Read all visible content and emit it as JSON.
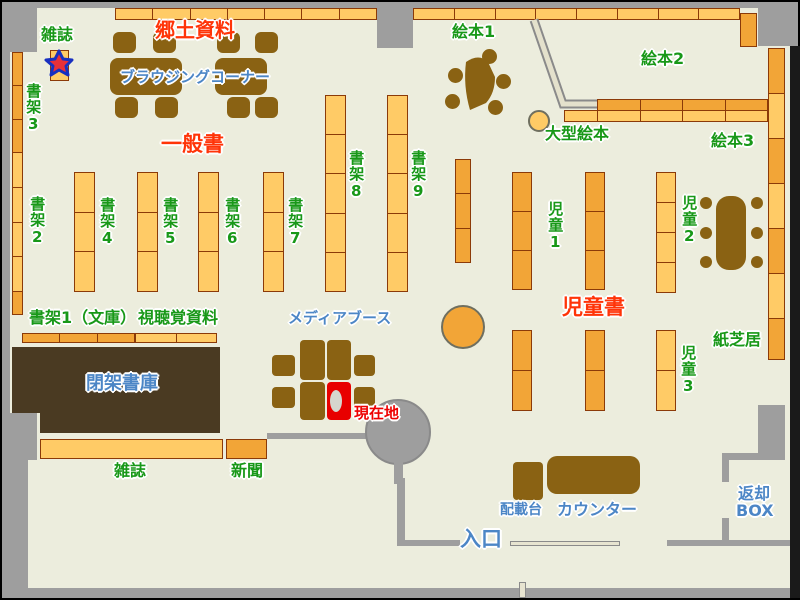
{
  "map_title": "library-floor-map",
  "palette": {
    "floor": "#ECEDDD",
    "wall_gray": "#9E9E9E",
    "shelf_light": "#FFCB66",
    "shelf_dark": "#F2A537",
    "shelf_border": "#8B3A08",
    "furniture_brown": "#8A6213",
    "closed_stacks_brown": "#4A3A22",
    "label_green": "#189818",
    "label_red": "#FF3408",
    "label_blue": "#4C86C6",
    "current_location_red": "#E80000"
  },
  "labels": [
    {
      "name": "label-zasshi-top",
      "text": "雑誌",
      "x": 41,
      "y": 26,
      "color": "green",
      "size": 16,
      "vertical": false
    },
    {
      "name": "label-shoka3",
      "text": "書架3",
      "x": 25,
      "y": 83,
      "color": "green",
      "size": 15,
      "vertical": true
    },
    {
      "name": "label-shoka2",
      "text": "書架2",
      "x": 29,
      "y": 196,
      "color": "green",
      "size": 15,
      "vertical": true
    },
    {
      "name": "label-kyodo-shiryo",
      "text": "郷土資料",
      "x": 155,
      "y": 20,
      "color": "red",
      "size": 20,
      "vertical": false
    },
    {
      "name": "label-browsing-corner",
      "text": "ブラウジングコーナー",
      "x": 120,
      "y": 69,
      "color": "blue",
      "size": 15,
      "vertical": false
    },
    {
      "name": "label-ippansho",
      "text": "一般書",
      "x": 161,
      "y": 133,
      "color": "red",
      "size": 21,
      "vertical": false
    },
    {
      "name": "label-shoka4",
      "text": "書架4",
      "x": 99,
      "y": 197,
      "color": "green",
      "size": 15,
      "vertical": true
    },
    {
      "name": "label-shoka5",
      "text": "書架5",
      "x": 162,
      "y": 197,
      "color": "green",
      "size": 15,
      "vertical": true
    },
    {
      "name": "label-shoka6",
      "text": "書架6",
      "x": 224,
      "y": 197,
      "color": "green",
      "size": 15,
      "vertical": true
    },
    {
      "name": "label-shoka7",
      "text": "書架7",
      "x": 287,
      "y": 197,
      "color": "green",
      "size": 15,
      "vertical": true
    },
    {
      "name": "label-shoka8",
      "text": "書架8",
      "x": 348,
      "y": 150,
      "color": "green",
      "size": 15,
      "vertical": true
    },
    {
      "name": "label-shoka9",
      "text": "書架9",
      "x": 410,
      "y": 150,
      "color": "green",
      "size": 15,
      "vertical": true
    },
    {
      "name": "label-shoka1-bunko",
      "text": "書架1（文庫）",
      "x": 29,
      "y": 309,
      "color": "green",
      "size": 16,
      "vertical": false
    },
    {
      "name": "label-shichokaku-shiryo",
      "text": "視聴覚資料",
      "x": 138,
      "y": 309,
      "color": "green",
      "size": 16,
      "vertical": false
    },
    {
      "name": "label-ehon1",
      "text": "絵本1",
      "x": 452,
      "y": 23,
      "color": "green",
      "size": 16,
      "vertical": false
    },
    {
      "name": "label-ehon2",
      "text": "絵本2",
      "x": 641,
      "y": 50,
      "color": "green",
      "size": 16,
      "vertical": false
    },
    {
      "name": "label-ehon3",
      "text": "絵本3",
      "x": 711,
      "y": 132,
      "color": "green",
      "size": 16,
      "vertical": false
    },
    {
      "name": "label-ogata-ehon",
      "text": "大型絵本",
      "x": 545,
      "y": 125,
      "color": "green",
      "size": 16,
      "vertical": false
    },
    {
      "name": "label-jido1",
      "text": "児童1",
      "x": 547,
      "y": 201,
      "color": "green",
      "size": 15,
      "vertical": true
    },
    {
      "name": "label-jido2",
      "text": "児童2",
      "x": 681,
      "y": 195,
      "color": "green",
      "size": 15,
      "vertical": true
    },
    {
      "name": "label-jido3",
      "text": "児童3",
      "x": 680,
      "y": 345,
      "color": "green",
      "size": 15,
      "vertical": true
    },
    {
      "name": "label-jidosho",
      "text": "児童書",
      "x": 562,
      "y": 296,
      "color": "red",
      "size": 21,
      "vertical": false
    },
    {
      "name": "label-kamishibai",
      "text": "紙芝居",
      "x": 713,
      "y": 331,
      "color": "green",
      "size": 16,
      "vertical": false
    },
    {
      "name": "label-heika-shoko",
      "text": "閉架書庫",
      "x": 86,
      "y": 374,
      "color": "blue",
      "size": 18,
      "vertical": false
    },
    {
      "name": "label-media-booth",
      "text": "メディアブース",
      "x": 288,
      "y": 310,
      "color": "blue",
      "size": 15,
      "vertical": false
    },
    {
      "name": "label-genzaichi",
      "text": "現在地",
      "x": 354,
      "y": 405,
      "color": "red-bright",
      "size": 15,
      "vertical": false
    },
    {
      "name": "label-zasshi-bottom",
      "text": "雑誌",
      "x": 114,
      "y": 462,
      "color": "green",
      "size": 16,
      "vertical": false
    },
    {
      "name": "label-shimbun",
      "text": "新聞",
      "x": 231,
      "y": 462,
      "color": "green",
      "size": 16,
      "vertical": false
    },
    {
      "name": "label-haisaidai",
      "text": "配載台",
      "x": 500,
      "y": 503,
      "color": "blue",
      "size": 14,
      "vertical": false
    },
    {
      "name": "label-counter",
      "text": "カウンター",
      "x": 557,
      "y": 501,
      "color": "blue",
      "size": 16,
      "vertical": false
    },
    {
      "name": "label-henkyaku",
      "text": "返却",
      "x": 738,
      "y": 485,
      "color": "blue",
      "size": 16,
      "vertical": false
    },
    {
      "name": "label-henkyaku-box",
      "text": "BOX",
      "x": 736,
      "y": 502,
      "color": "blue",
      "size": 16,
      "vertical": false
    },
    {
      "name": "label-iriguchi",
      "text": "入口",
      "x": 460,
      "y": 528,
      "color": "blue",
      "size": 21,
      "vertical": false
    }
  ],
  "shelves": [
    {
      "name": "shelf-top-row-left",
      "x": 115,
      "y": 8,
      "w": 262,
      "h": 12,
      "segments": 7,
      "variant": "light",
      "dir": "h"
    },
    {
      "name": "shelf-top-row-right",
      "x": 413,
      "y": 8,
      "w": 327,
      "h": 12,
      "segments": 8,
      "variant": "light",
      "dir": "h"
    },
    {
      "name": "shelf-top-row-endcap",
      "x": 740,
      "y": 13,
      "w": 17,
      "h": 34,
      "segments": 1,
      "variant": "dark",
      "dir": "v"
    },
    {
      "name": "shelf-wall-left-a",
      "x": 12,
      "y": 52,
      "w": 11,
      "h": 101,
      "segments": 3,
      "variant": "dark",
      "dir": "v"
    },
    {
      "name": "shelf-wall-left-b",
      "x": 12,
      "y": 152,
      "w": 11,
      "h": 140,
      "segments": 4,
      "variant": "light",
      "dir": "v"
    },
    {
      "name": "shelf-wall-left-c",
      "x": 12,
      "y": 291,
      "w": 11,
      "h": 24,
      "segments": 1,
      "variant": "dark",
      "dir": "v"
    },
    {
      "name": "shelf-magazine-card",
      "x": 50,
      "y": 50,
      "w": 19,
      "h": 31,
      "segments": 1,
      "variant": "light",
      "dir": "v"
    },
    {
      "name": "shelf-col-4",
      "x": 74,
      "y": 172,
      "w": 21,
      "h": 120,
      "segments": 3,
      "variant": "light",
      "dir": "v"
    },
    {
      "name": "shelf-col-5",
      "x": 137,
      "y": 172,
      "w": 21,
      "h": 120,
      "segments": 3,
      "variant": "light",
      "dir": "v"
    },
    {
      "name": "shelf-col-6",
      "x": 198,
      "y": 172,
      "w": 21,
      "h": 120,
      "segments": 3,
      "variant": "light",
      "dir": "v"
    },
    {
      "name": "shelf-col-7",
      "x": 263,
      "y": 172,
      "w": 21,
      "h": 120,
      "segments": 3,
      "variant": "light",
      "dir": "v"
    },
    {
      "name": "shelf-col-8",
      "x": 325,
      "y": 95,
      "w": 21,
      "h": 197,
      "segments": 5,
      "variant": "light",
      "dir": "v"
    },
    {
      "name": "shelf-col-9",
      "x": 387,
      "y": 95,
      "w": 21,
      "h": 197,
      "segments": 5,
      "variant": "light",
      "dir": "v"
    },
    {
      "name": "shelf-center-narrow",
      "x": 455,
      "y": 159,
      "w": 16,
      "h": 104,
      "segments": 3,
      "variant": "dark",
      "dir": "v"
    },
    {
      "name": "shelf-row-bunko",
      "x": 22,
      "y": 333,
      "w": 113,
      "h": 10,
      "segments": 3,
      "variant": "dark",
      "dir": "h"
    },
    {
      "name": "shelf-row-av",
      "x": 135,
      "y": 333,
      "w": 82,
      "h": 10,
      "segments": 2,
      "variant": "light",
      "dir": "h"
    },
    {
      "name": "shelf-kids-1-upper",
      "x": 512,
      "y": 172,
      "w": 20,
      "h": 118,
      "segments": 3,
      "variant": "dark",
      "dir": "v"
    },
    {
      "name": "shelf-kids-2-upper",
      "x": 585,
      "y": 172,
      "w": 20,
      "h": 118,
      "segments": 3,
      "variant": "dark",
      "dir": "v"
    },
    {
      "name": "shelf-kids-3-upper",
      "x": 656,
      "y": 172,
      "w": 20,
      "h": 121,
      "segments": 4,
      "variant": "light",
      "dir": "v"
    },
    {
      "name": "shelf-kids-1-lower",
      "x": 512,
      "y": 330,
      "w": 20,
      "h": 81,
      "segments": 2,
      "variant": "dark",
      "dir": "v"
    },
    {
      "name": "shelf-kids-2-lower",
      "x": 585,
      "y": 330,
      "w": 20,
      "h": 81,
      "segments": 2,
      "variant": "dark",
      "dir": "v"
    },
    {
      "name": "shelf-kids-3-lower",
      "x": 656,
      "y": 330,
      "w": 20,
      "h": 81,
      "segments": 2,
      "variant": "light",
      "dir": "v"
    },
    {
      "name": "shelf-wall-right-1",
      "x": 768,
      "y": 48,
      "w": 17,
      "h": 46,
      "segments": 1,
      "variant": "dark",
      "dir": "v"
    },
    {
      "name": "shelf-wall-right-2",
      "x": 768,
      "y": 93,
      "w": 17,
      "h": 46,
      "segments": 1,
      "variant": "light",
      "dir": "v"
    },
    {
      "name": "shelf-wall-right-3",
      "x": 768,
      "y": 138,
      "w": 17,
      "h": 46,
      "segments": 1,
      "variant": "dark",
      "dir": "v"
    },
    {
      "name": "shelf-wall-right-4",
      "x": 768,
      "y": 183,
      "w": 17,
      "h": 46,
      "segments": 1,
      "variant": "light",
      "dir": "v"
    },
    {
      "name": "shelf-wall-right-5",
      "x": 768,
      "y": 228,
      "w": 17,
      "h": 46,
      "segments": 1,
      "variant": "dark",
      "dir": "v"
    },
    {
      "name": "shelf-wall-right-6",
      "x": 768,
      "y": 273,
      "w": 17,
      "h": 46,
      "segments": 1,
      "variant": "light",
      "dir": "v"
    },
    {
      "name": "shelf-wall-right-7",
      "x": 768,
      "y": 318,
      "w": 17,
      "h": 42,
      "segments": 1,
      "variant": "dark",
      "dir": "v"
    },
    {
      "name": "shelf-ehon-divider-top",
      "x": 597,
      "y": 99,
      "w": 171,
      "h": 12,
      "segments": 4,
      "variant": "dark",
      "dir": "h"
    },
    {
      "name": "shelf-ehon-divider-bottom",
      "x": 597,
      "y": 110,
      "w": 171,
      "h": 12,
      "segments": 4,
      "variant": "light",
      "dir": "h"
    },
    {
      "name": "shelf-ehon-divider-end",
      "x": 564,
      "y": 110,
      "w": 34,
      "h": 12,
      "segments": 1,
      "variant": "light",
      "dir": "h"
    },
    {
      "name": "shelf-zasshi-bottom",
      "x": 40,
      "y": 439,
      "w": 183,
      "h": 20,
      "segments": 1,
      "variant": "light",
      "dir": "h"
    },
    {
      "name": "shelf-shimbun",
      "x": 226,
      "y": 439,
      "w": 41,
      "h": 20,
      "segments": 1,
      "variant": "dark",
      "dir": "h"
    }
  ],
  "walls": [
    {
      "name": "wall-top-bar",
      "x": 2,
      "y": 2,
      "w": 796,
      "h": 6
    },
    {
      "name": "wall-topleft-block",
      "x": 2,
      "y": 2,
      "w": 35,
      "h": 50
    },
    {
      "name": "wall-left",
      "x": 2,
      "y": 2,
      "w": 8,
      "h": 458
    },
    {
      "name": "wall-bottomleft-block",
      "x": 2,
      "y": 413,
      "w": 35,
      "h": 47
    },
    {
      "name": "wall-bottomleft",
      "x": 2,
      "y": 460,
      "w": 26,
      "h": 138
    },
    {
      "name": "wall-bottom-bar",
      "x": 2,
      "y": 588,
      "w": 796,
      "h": 10
    },
    {
      "name": "wall-top-pillar",
      "x": 377,
      "y": 2,
      "w": 36,
      "h": 46
    },
    {
      "name": "wall-topright-block",
      "x": 758,
      "y": 8,
      "w": 40,
      "h": 38
    },
    {
      "name": "wall-right-edge",
      "x": 790,
      "y": 46,
      "w": 10,
      "h": 552,
      "color": "#1A1A1A"
    },
    {
      "name": "wall-mid-horizontal",
      "x": 267,
      "y": 433,
      "w": 101,
      "h": 6
    },
    {
      "name": "wall-pillar-circle",
      "x": 365,
      "y": 399,
      "w": 66,
      "h": 66,
      "shape": "circle"
    },
    {
      "name": "wall-pillar-stem",
      "x": 394,
      "y": 460,
      "w": 9,
      "h": 24
    },
    {
      "name": "wall-entrance-left-v",
      "x": 397,
      "y": 478,
      "w": 8,
      "h": 68
    },
    {
      "name": "wall-entrance-left-h",
      "x": 397,
      "y": 540,
      "w": 63,
      "h": 6
    },
    {
      "name": "wall-entrance-right-h",
      "x": 667,
      "y": 540,
      "w": 123,
      "h": 6
    },
    {
      "name": "wall-entrance-right-v",
      "x": 722,
      "y": 518,
      "w": 7,
      "h": 26
    },
    {
      "name": "wall-box-vertical",
      "x": 758,
      "y": 405,
      "w": 27,
      "h": 55
    },
    {
      "name": "wall-box-horizontal",
      "x": 722,
      "y": 453,
      "w": 63,
      "h": 7
    },
    {
      "name": "wall-box-vertical2",
      "x": 722,
      "y": 460,
      "w": 7,
      "h": 22
    },
    {
      "name": "entrance-door-slide",
      "x": 510,
      "y": 541,
      "w": 110,
      "h": 5,
      "shape": "beige"
    },
    {
      "name": "entrance-outside-post",
      "x": 519,
      "y": 582,
      "w": 7,
      "h": 16,
      "shape": "beige"
    }
  ],
  "furniture": [
    {
      "name": "closed-stacks-area-left",
      "x": 12,
      "y": 347,
      "w": 28,
      "h": 66,
      "fill": "dark-brown"
    },
    {
      "name": "closed-stacks-area",
      "x": 40,
      "y": 347,
      "w": 180,
      "h": 86,
      "fill": "dark-brown"
    },
    {
      "name": "browsing-table-1",
      "x": 110,
      "y": 58,
      "w": 72,
      "h": 37,
      "fill": "brown",
      "r": 8
    },
    {
      "name": "browsing-table-2",
      "x": 215,
      "y": 58,
      "w": 52,
      "h": 37,
      "fill": "brown",
      "r": 8
    },
    {
      "name": "browsing-chair",
      "x": 113,
      "y": 32,
      "w": 23,
      "h": 21,
      "fill": "brown",
      "r": 6
    },
    {
      "name": "browsing-chair",
      "x": 153,
      "y": 32,
      "w": 23,
      "h": 21,
      "fill": "brown",
      "r": 6
    },
    {
      "name": "browsing-chair",
      "x": 217,
      "y": 32,
      "w": 23,
      "h": 21,
      "fill": "brown",
      "r": 6
    },
    {
      "name": "browsing-chair",
      "x": 255,
      "y": 32,
      "w": 23,
      "h": 21,
      "fill": "brown",
      "r": 6
    },
    {
      "name": "browsing-chair",
      "x": 115,
      "y": 97,
      "w": 23,
      "h": 21,
      "fill": "brown",
      "r": 6
    },
    {
      "name": "browsing-chair",
      "x": 155,
      "y": 97,
      "w": 23,
      "h": 21,
      "fill": "brown",
      "r": 6
    },
    {
      "name": "browsing-chair",
      "x": 227,
      "y": 97,
      "w": 23,
      "h": 21,
      "fill": "brown",
      "r": 6
    },
    {
      "name": "browsing-chair",
      "x": 255,
      "y": 97,
      "w": 23,
      "h": 21,
      "fill": "brown",
      "r": 6
    },
    {
      "name": "ehon1-stool",
      "x": 448,
      "y": 68,
      "w": 15,
      "h": 15,
      "fill": "brown",
      "r": 50
    },
    {
      "name": "ehon1-stool",
      "x": 445,
      "y": 94,
      "w": 15,
      "h": 15,
      "fill": "brown",
      "r": 50
    },
    {
      "name": "ehon1-stool",
      "x": 482,
      "y": 49,
      "w": 15,
      "h": 15,
      "fill": "brown",
      "r": 50
    },
    {
      "name": "ehon1-stool",
      "x": 496,
      "y": 74,
      "w": 15,
      "h": 15,
      "fill": "brown",
      "r": 50
    },
    {
      "name": "ehon1-stool",
      "x": 488,
      "y": 100,
      "w": 15,
      "h": 15,
      "fill": "brown",
      "r": 50
    },
    {
      "name": "ogata-ehon-circle",
      "x": 528,
      "y": 110,
      "w": 22,
      "h": 22,
      "fill": "orange-light",
      "r": 50
    },
    {
      "name": "center-circle-table",
      "x": 441,
      "y": 305,
      "w": 44,
      "h": 44,
      "fill": "orange-dark",
      "r": 50
    },
    {
      "name": "kids-table",
      "x": 716,
      "y": 196,
      "w": 30,
      "h": 74,
      "fill": "brown",
      "r": 13
    },
    {
      "name": "kids-stool",
      "x": 700,
      "y": 197,
      "w": 12,
      "h": 12,
      "fill": "brown",
      "r": 50
    },
    {
      "name": "kids-stool",
      "x": 700,
      "y": 227,
      "w": 12,
      "h": 12,
      "fill": "brown",
      "r": 50
    },
    {
      "name": "kids-stool",
      "x": 700,
      "y": 256,
      "w": 12,
      "h": 12,
      "fill": "brown",
      "r": 50
    },
    {
      "name": "kids-stool",
      "x": 751,
      "y": 197,
      "w": 12,
      "h": 12,
      "fill": "brown",
      "r": 50
    },
    {
      "name": "kids-stool",
      "x": 751,
      "y": 227,
      "w": 12,
      "h": 12,
      "fill": "brown",
      "r": 50
    },
    {
      "name": "kids-stool",
      "x": 751,
      "y": 256,
      "w": 12,
      "h": 12,
      "fill": "brown",
      "r": 50
    },
    {
      "name": "media-booth-cell",
      "x": 272,
      "y": 355,
      "w": 23,
      "h": 21,
      "fill": "brown",
      "r": 4
    },
    {
      "name": "media-booth-cell",
      "x": 272,
      "y": 387,
      "w": 23,
      "h": 21,
      "fill": "brown",
      "r": 4
    },
    {
      "name": "media-booth-cell",
      "x": 354,
      "y": 355,
      "w": 21,
      "h": 21,
      "fill": "brown",
      "r": 4
    },
    {
      "name": "media-booth-cell",
      "x": 354,
      "y": 387,
      "w": 21,
      "h": 21,
      "fill": "brown",
      "r": 4
    },
    {
      "name": "media-booth-cell",
      "x": 300,
      "y": 340,
      "w": 25,
      "h": 40,
      "fill": "brown",
      "r": 4
    },
    {
      "name": "media-booth-cell",
      "x": 300,
      "y": 382,
      "w": 25,
      "h": 38,
      "fill": "brown",
      "r": 4
    },
    {
      "name": "media-booth-cell",
      "x": 327,
      "y": 340,
      "w": 24,
      "h": 40,
      "fill": "brown",
      "r": 4
    },
    {
      "name": "current-location-cell",
      "x": 327,
      "y": 382,
      "w": 24,
      "h": 38,
      "fill": "red",
      "r": 4
    },
    {
      "name": "return-cart",
      "x": 513,
      "y": 462,
      "w": 30,
      "h": 38,
      "fill": "brown",
      "r": 4
    },
    {
      "name": "counter-desk",
      "x": 547,
      "y": 456,
      "w": 93,
      "h": 38,
      "fill": "brown",
      "r": 10
    }
  ]
}
